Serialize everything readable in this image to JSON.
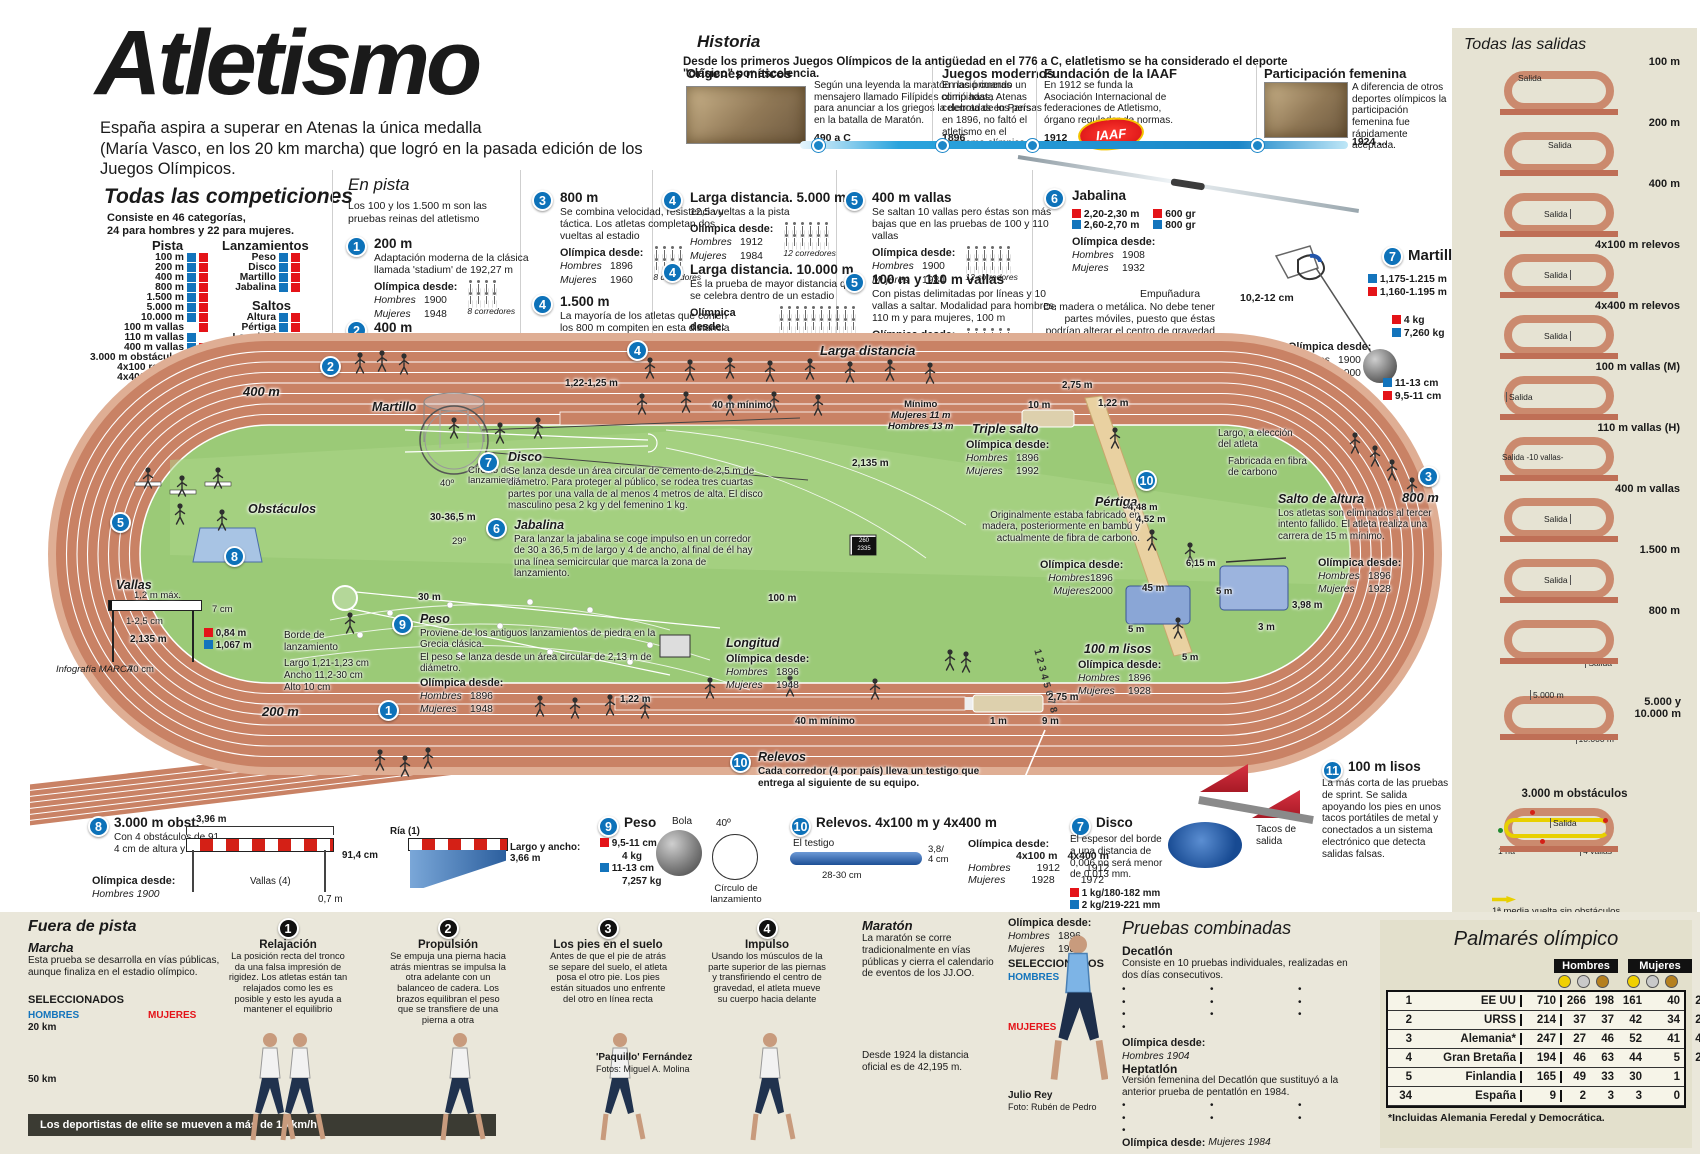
{
  "colors": {
    "accent_blue": "#0d72b9",
    "hombres_blue": "#1374bc",
    "mujeres_red": "#e41318",
    "track": "#c98265",
    "infield": "#9bca77",
    "panel_beige": "#e6e3d3",
    "band_beige": "#eae7da",
    "timeline_blue": "#2aa4dd",
    "gold": "#f0d000",
    "silver": "#c9c9c9",
    "bronze": "#b5801f"
  },
  "labels": {
    "olimpica": "Olímpica desde:",
    "hombres": "Hombres",
    "mujeres": "Mujeres"
  },
  "header": {
    "title": "Atletismo",
    "sub1": "España aspira a superar en Atenas la única medalla",
    "sub2": "(María Vasco, en los 20 km marcha) que logró en la pasada edición de los Juegos Olímpicos."
  },
  "historia": {
    "title": "Historia",
    "intro": "Desde los primeros Juegos Olímpicos de la antigüedad en el 776 a C, elatletismo se ha considerado el deporte \"clásico\" por escelencia.",
    "iaaf": "IAAF",
    "items": [
      {
        "title": "Orígenes míticos",
        "text": "Según una leyenda la maratón nació cuando un mensajero llamado Filípides corrió hasta Atenas para anunciar a los griegos la derrota de los persas en la batalla de Maratón.",
        "year": "490 a C"
      },
      {
        "title": "Juegos modernos",
        "text": "En las primeras olimpiadas, celebradas en París en 1896, no faltó el atletismo en el programa olímpico.",
        "year": "1896"
      },
      {
        "title": "Fundación de la IAAF",
        "text": "En 1912 se funda la Asociación Internacional de federaciones de Atletismo, órgano regulador de normas.",
        "year": "1912"
      },
      {
        "title": "Participación femenina",
        "text": "A diferencia de otros deportes olímpicos la participación femenina fue rápidamente aceptada.",
        "year": "1924 ..."
      }
    ]
  },
  "competiciones": {
    "title": "Todas las competiciones",
    "intro1": "Consiste en 46 categorías,",
    "intro2": "24 para hombres y 22 para mujeres.",
    "legend_h": "Hombres",
    "legend_m": "Mujeres",
    "pista": {
      "name": "Pista",
      "items": [
        {
          "label": "100 m",
          "h": true,
          "m": true
        },
        {
          "label": "200 m",
          "h": true,
          "m": true
        },
        {
          "label": "400 m",
          "h": true,
          "m": true
        },
        {
          "label": "800 m",
          "h": true,
          "m": true
        },
        {
          "label": "1.500 m",
          "h": true,
          "m": true
        },
        {
          "label": "5.000 m",
          "h": true,
          "m": true
        },
        {
          "label": "10.000 m",
          "h": true,
          "m": true
        },
        {
          "label": "100 m vallas",
          "h": false,
          "m": true
        },
        {
          "label": "110 m vallas",
          "h": true,
          "m": false
        },
        {
          "label": "400 m vallas",
          "h": true,
          "m": true
        },
        {
          "label": "3.000 m obstáculos",
          "h": true,
          "m": false
        },
        {
          "label": "4x100 relevos",
          "h": true,
          "m": true
        },
        {
          "label": "4x400 relevos",
          "h": true,
          "m": true
        }
      ]
    },
    "lanzamientos": {
      "name": "Lanzamientos",
      "items": [
        {
          "label": "Peso",
          "h": true,
          "m": true
        },
        {
          "label": "Disco",
          "h": true,
          "m": true
        },
        {
          "label": "Martillo",
          "h": true,
          "m": true
        },
        {
          "label": "Jabalina",
          "h": true,
          "m": true
        }
      ]
    },
    "saltos": {
      "name": "Saltos",
      "items": [
        {
          "label": "Altura",
          "h": true,
          "m": true
        },
        {
          "label": "Pértiga",
          "h": true,
          "m": true
        },
        {
          "label": "Longitud",
          "h": true,
          "m": true
        },
        {
          "label": "Triple",
          "h": true,
          "m": true
        }
      ]
    },
    "combinadas": {
      "name": "Combinadas",
      "items": [
        {
          "label": "Decatlon",
          "h": true,
          "m": false
        },
        {
          "label": "Heptatlon",
          "h": false,
          "m": true
        }
      ]
    },
    "fuera": {
      "name": "Fuera de pista",
      "items": [
        {
          "label": "Maratón",
          "h": true,
          "m": true
        },
        {
          "label": "20 km marcha",
          "h": true,
          "m": true
        },
        {
          "label": "50 km marcha",
          "h": true,
          "m": false
        }
      ]
    }
  },
  "en_pista": {
    "title": "En pista",
    "intro": "Los 100 y los 1.500 m son las pruebas reinas del atletismo",
    "events": [
      {
        "n": "1",
        "name": "200 m",
        "desc": "Adaptación moderna de la clásica llamada 'stadium' de 192,27 m",
        "h": "1900",
        "m": "1948",
        "rows": "4,4",
        "cap": "8 corredores"
      },
      {
        "n": "2",
        "name": "400 m",
        "desc": "",
        "h": "1896",
        "m": "1964",
        "rows": "4,4",
        "cap": "8 corredores"
      },
      {
        "n": "3",
        "name": "800 m",
        "desc": "Se combina velocidad, resistencia y táctica. Los atletas completan dos vueltas al estadio",
        "h": "1896",
        "m": "1960",
        "rows": "4,4",
        "cap": "8 corredores"
      },
      {
        "n": "4",
        "name": "1.500 m",
        "desc": "La mayoría de los atletas que corren los 800 m  compiten en esta distancia",
        "h": "1896",
        "m": "1972",
        "rows": "6,6",
        "cap": "12 corredores"
      },
      {
        "n": "4",
        "name": "Larga distancia. 5.000 m",
        "desc": "12,5 vueltas a la pista",
        "h": "1912",
        "m": "1984",
        "rows": "6,6",
        "cap": "12 corredores"
      },
      {
        "n": "4",
        "name": "Larga distancia. 10.000 m",
        "desc": "Es la prueba de mayor distancia que se celebra dentro de un estadio",
        "h": "1912",
        "m": "1988",
        "rows": "10,10",
        "cap": "25-30 corredores"
      },
      {
        "n": "5",
        "name": "400 m vallas",
        "desc": "Se saltan 10 vallas pero éstas son más bajas que en las pruebas de 100 y 110 vallas",
        "h": "1900",
        "m": "1984",
        "rows": "6,6",
        "cap": "12 corredores"
      },
      {
        "n": "5",
        "name": "100 m y 110 m vallas",
        "desc": "Con pistas delimitadas por líneas y 10 vallas a saltar. Modalidad para hombres, 110 m y para mujeres, 100 m",
        "h": "1896",
        "m": "1932",
        "rows": "6,6",
        "cap": "12 corredores"
      }
    ]
  },
  "jabalina": {
    "n": "6",
    "name": "Jabalina",
    "len_r": "2,20-2,30 m",
    "len_b": "2,60-2,70 m",
    "w_r": "600 gr",
    "w_b": "800 gr",
    "h": "1908",
    "m": "1932",
    "emp_t": "Empuñadura",
    "emp_txt": "De madera o metálica. No debe tener partes móviles, puesto que éstas podrían alterar el centro de gravedad y hacer más fácil el lanzamiento.",
    "emp_d": "10,2-12 cm"
  },
  "martillo": {
    "n": "7",
    "name": "Martillo",
    "len_b": "1,175-1.215 m",
    "len_r": "1,160-1.195 m",
    "w_r": "4 kg",
    "w_b": "7,260 kg",
    "d_b": "11-13 cm",
    "d_r": "9,5-11 cm",
    "h": "1900",
    "m": "2000"
  },
  "track": {
    "m400": "400 m",
    "m200": "200 m",
    "m800": "800 m",
    "larga": "Larga distancia",
    "b1": "1",
    "b2": "2",
    "b3": "3",
    "b4": "4",
    "b5": "5",
    "b6": "6",
    "b7": "7",
    "b8": "8",
    "b9": "9",
    "b10": "10",
    "b11": "11",
    "martillo": "Martillo",
    "circulo": "Círculo de lanzamiento",
    "deg40": "40º",
    "disco_t": "Disco",
    "disco_txt": "Se lanza desde un área circular de cemento de 2,5 m de diámetro. Para proteger al público, se rodea tres cuartas partes por una valla de al menos 4 metros de alta. El disco masculino pesa 2 kg y del femenino 1 kg.",
    "obstaculos": "Obstáculos",
    "jab_t": "Jabalina",
    "jab_txt": "Para lanzar la jabalina se coge impulso en un corredor de 30 a 36,5 m de largo y 4 de ancho, al final de él hay una línea semicircular que marca la zona de lanzamiento.",
    "jab_d1": "30-36,5 m",
    "jab_deg": "29º",
    "jab_d2": "30 m",
    "vallas_t": "Vallas",
    "vallas_top": "1,2 m máx.",
    "vallas_7": "7 cm",
    "vallas_125": "1-2,5 cm",
    "vallas_084": "0,84 m",
    "vallas_1067": "1,067 m",
    "vallas_70": "70 cm",
    "peso_t": "Peso",
    "peso_t1": "Proviene de los antiguos lanzamientos de piedra en la Grecia clásica.",
    "peso_t2": "El peso se lanza desde un área circular de 2,13 m de diámetro.",
    "peso_h": "1896",
    "peso_m": "1948",
    "borde1": "Borde de",
    "borde2": "lanzamiento",
    "borde_l": "Largo  1,21-1,23 cm",
    "borde_a": "Ancho  11,2-30 cm",
    "borde_al": "Alto     10 cm",
    "d2135a": "2,135 m",
    "d2135b": "2,135 m",
    "d30": "30 m",
    "d100": "100 m",
    "sb1": "260",
    "sb2": "2335",
    "top_w": "1,22-1,25 m",
    "top_min": "40 m mínimo",
    "minimo": "Mínimo",
    "min_m": "Mujeres  11 m",
    "min_h": "Hombres  13 m",
    "d10": "10 m",
    "d275a": "2,75 m",
    "triple_t": "Triple salto",
    "triple_h": "1896",
    "triple_m": "1992",
    "longitud_t": "Longitud",
    "long_h": "1896",
    "long_m": "1948",
    "long_w": "1,22 m",
    "long_min": "40 m mínimo",
    "d1": "1 m",
    "d9": "9 m",
    "d275b": "2,75 m",
    "pert_t": "Pértiga",
    "pert_txt": "Originalmente estaba fabricado en madera, posteriormente en bambú y actualmente de fibra de carbono.",
    "pert_h": "1896",
    "pert_m": "2000",
    "d45": "45 m",
    "d122": "1,22 m",
    "d448": "4,48 m",
    "d452": "4,52 m",
    "d615": "6,15 m",
    "d5a": "5 m",
    "d5b": "5 m",
    "d5c": "5 m",
    "carbon1": "Largo, a elección",
    "carbon2": "del atleta",
    "carbon3": "Fabricada en fibra",
    "carbon4": "de carbono",
    "cien_t": "100 m lisos",
    "cien_h": "1896",
    "cien_m": "1928",
    "altura_t": "Salto de altura",
    "altura_txt": "Los atletas son eliminados al tercer intento fallido. El atleta realiza una carrera de 15 m mínimo.",
    "altura_h": "1896",
    "altura_m": "1928",
    "d398": "3,98 m",
    "d3": "3 m",
    "relevos_t": "Relevos",
    "relevos_txt": "Cada corredor (4 por país) lleva un testigo que entrega al siguiente de su equipo.",
    "lanes": "12345678"
  },
  "salidas": {
    "title": "Todas las salidas",
    "items": [
      {
        "label": "100 m",
        "salida": "Salida",
        "v": "tl"
      },
      {
        "label": "200 m",
        "salida": "Salida",
        "v": "tm"
      },
      {
        "label": "400 m",
        "salida": "Salida",
        "v": "r"
      },
      {
        "label": "4x100 m relevos",
        "salida": "Salida",
        "v": "r"
      },
      {
        "label": "4x400 m relevos",
        "salida": "Salida",
        "v": "r"
      },
      {
        "label": "100 m vallas (M)",
        "salida": "Salida",
        "v": "l"
      },
      {
        "label": "110 m vallas (H)",
        "salida": "Salida -10 vallas-",
        "v": "l2"
      },
      {
        "label": "400 m vallas",
        "salida": "Salida",
        "v": "r"
      },
      {
        "label": "1.500 m",
        "salida": "Salida",
        "v": "r"
      },
      {
        "label": "800 m",
        "salida": "Salida",
        "v": "br"
      }
    ],
    "five_ten": {
      "label1": "5.000 y",
      "label2": "10.000 m",
      "s1": "5.000 m",
      "s2": "10.000 m"
    },
    "obst": {
      "label": "3.000 m obstáculos",
      "salida": "Salida",
      "ria": "1 ría",
      "vallas": "4 vallas"
    },
    "note1": "1ª media vuelta sin obstáculos.",
    "note2": "Las siguientes pasarán por todos."
  },
  "bottom": {
    "obst": {
      "n": "8",
      "title": "3.000 m obst.",
      "text": "Con 4 obstáculos de 91, 4 cm de altura y un ría.",
      "h": "Hombres  1900",
      "d396": "3,96 m",
      "d914": "91,4 cm",
      "ria": "Ría (1)",
      "vallas": "Vallas (4)",
      "d07": "0,7 m",
      "largo": "Largo y ancho: 3,66 m"
    },
    "peso": {
      "n": "9",
      "title": "Peso",
      "r": "9,5-11 cm",
      "rkg": "4 kg",
      "b": "11-13 cm",
      "bkg": "7,257 kg",
      "bola": "Bola",
      "deg": "40º",
      "circulo": "Círculo de lanzamiento"
    },
    "relevos": {
      "n": "10",
      "title": "Relevos. 4x100 m y 4x400 m",
      "testigo": "El testigo",
      "d38": "3,8/",
      "d4": "4 cm",
      "d2830": "28-30 cm",
      "c1": "4x100 m",
      "c2": "4x400 m",
      "h1": "1912",
      "h2": "1912",
      "m1": "1928",
      "m2": "1972"
    },
    "disco": {
      "n": "7",
      "title": "Disco",
      "text": "El espesor del borde a una distancia de 0,006 no será menor de 0,013 mm.",
      "r": "1 kg/180-182 mm",
      "b": "2 kg/219-221 mm"
    },
    "cien": {
      "n": "11",
      "title": "100 m lisos",
      "text": "La más corta de las pruebas de sprint. Se salida apoyando los pies en unos tacos portátiles de metal y conectados a un sistema electrónico que detecta salidas falsas.",
      "tacos": "Tacos de salida"
    }
  },
  "fuera": {
    "title": "Fuera de pista",
    "marcha": {
      "title": "Marcha",
      "text": "Esta prueba se desarrolla en vías públicas, aunque finaliza en el estadio olímpico.",
      "selec": "SELECCIONADOS",
      "hombres": "HOMBRES",
      "mujeres": "MUJERES",
      "h20": "20 km",
      "h20_names": [
        "Francisco Fernández",
        "Juan Manuel Molina",
        "José David Domínguez"
      ],
      "h50": "50 km",
      "h50_names": [
        "Jesús Ángel García",
        "Santiago Pérez",
        "José Antonio González"
      ],
      "m_names": [
        "María Vasco",
        "Beatriz Pascual",
        "Mayte Gargallo"
      ]
    },
    "steps": [
      {
        "n": "1",
        "title": "Relajación",
        "text": "La posición recta del tronco da una falsa impresión de rigidez. Los atletas están tan relajados como les es posible y esto les ayuda a mantener el equilibrio"
      },
      {
        "n": "2",
        "title": "Propulsión",
        "text": "Se empuja una pierna hacia atrás mientras se impulsa la otra adelante con un balanceo de cadera. Los brazos equilibran el peso que se transfiere de una pierna a otra"
      },
      {
        "n": "3",
        "title": "Los pies en el suelo",
        "text": "Antes de que el pie de atrás se separe del suelo, el atleta posa el otro pie. Los pies están situados uno enfrente del otro en línea recta"
      },
      {
        "n": "4",
        "title": "Impulso",
        "text": "Usando los músculos de la parte superior de las piernas y transfiriendo el centro de gravedad, el atleta mueve su cuerpo hacia delante"
      }
    ],
    "caption_name": "'Paquillo' Fernández",
    "caption_credit": "Fotos: Miguel A. Molina",
    "speedbar": "Los deportistas de elite se mueven a más de 15 km/h"
  },
  "maraton": {
    "title": "Maratón",
    "text": "La maratón se corre tradicionalmente en vías públicas y cierra el calendario de eventos de los JJ.OO.",
    "dist": "Desde 1924 la distancia oficial es de 42,195 m.",
    "h": "1896",
    "m": "1984",
    "selec": "SELECCIONADOS",
    "hombres": "HOMBRES",
    "h_names": [
      "José Ríos",
      "Julio Rey",
      "Antonio Peña"
    ],
    "mujeres": "MUJERES",
    "m_names": [
      "María Abel",
      "Beatriz Ros",
      "Dolores Pulido"
    ],
    "photo_name": "Julio Rey",
    "photo_credit": "Foto: Rubén de Pedro"
  },
  "combinadas": {
    "title": "Pruebas combinadas",
    "decatlon": {
      "name": "Decatlón",
      "text": "Consiste en 10 pruebas individuales, realizadas en dos días consecutivos.",
      "col1": [
        "100 m",
        "Longitud",
        "Peso",
        "Altura"
      ],
      "col2": [
        "400 m",
        "110 m vallas",
        "Disco"
      ],
      "col3": [
        "Pértiga",
        "Jabalina",
        "1.500 m"
      ],
      "o": "Hombres  1904"
    },
    "heptatlon": {
      "name": "Heptatlón",
      "text": "Versión femenina del Decatlón que sustituyó a la anterior prueba de pentatlón en 1984.",
      "col1": [
        "100 m vallas",
        "Altura",
        "Peso"
      ],
      "col2": [
        "200 m",
        "Longitud"
      ],
      "col3": [
        "Jabalina",
        "800 m"
      ],
      "o": "Mujeres  1984"
    }
  },
  "palmares": {
    "title": "Palmarés olímpico",
    "hombres": "Hombres",
    "mujeres": "Mujeres",
    "rows": [
      {
        "rank": "1",
        "country": "EE UU",
        "total": "710",
        "h1": "266",
        "h2": "198",
        "h3": "161",
        "m1": "40",
        "m2": "25",
        "m3": "20"
      },
      {
        "rank": "2",
        "country": "URSS",
        "total": "214",
        "h1": "37",
        "h2": "37",
        "h3": "42",
        "m1": "34",
        "m2": "29",
        "m3": "35"
      },
      {
        "rank": "3",
        "country": "Alemania*",
        "total": "247",
        "h1": "27",
        "h2": "46",
        "h3": "52",
        "m1": "41",
        "m2": "41",
        "m3": "40"
      },
      {
        "rank": "4",
        "country": "Gran Bretaña",
        "total": "194",
        "h1": "46",
        "h2": "63",
        "h3": "44",
        "m1": "5",
        "m2": "20",
        "m3": "16"
      },
      {
        "rank": "5",
        "country": "Finlandia",
        "total": "165",
        "h1": "49",
        "h2": "33",
        "h3": "30",
        "m1": "1",
        "m2": "2",
        "m3": "0"
      },
      {
        "rank": "34",
        "country": "España",
        "total": "9",
        "h1": "2",
        "h2": "3",
        "h3": "3",
        "m1": "0",
        "m2": "0",
        "m3": "1"
      }
    ],
    "note": "*Incluidas Alemania Feredal y Democrática."
  },
  "credit": "Infografía MARCA"
}
